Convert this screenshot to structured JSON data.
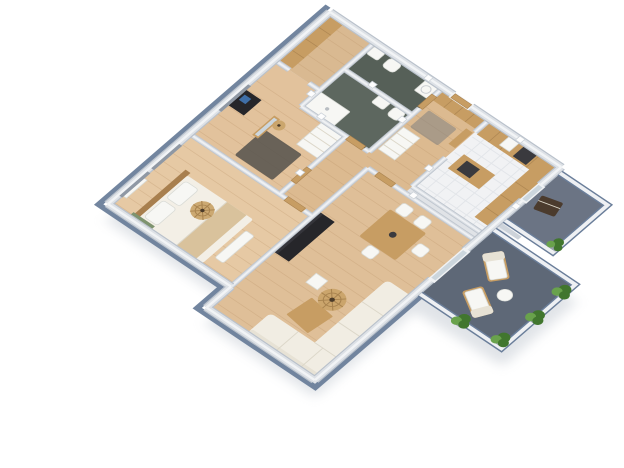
{
  "scene": {
    "type": "3d-floor-plan-render",
    "view": "rotated-isometric-top-down",
    "background": "white",
    "rooms": [
      {
        "name": "walk-in-closet",
        "floor": "wood",
        "furniture": [
          "built-in-wardrobe"
        ]
      },
      {
        "name": "bathroom-small",
        "floor": "dark-green-tile",
        "furniture": [
          "sink",
          "toilet",
          "washing-machine"
        ]
      },
      {
        "name": "bathroom-large",
        "floor": "dark-green-tile",
        "furniture": [
          "shower-tray",
          "sink",
          "toilet"
        ]
      },
      {
        "name": "entry-hall",
        "floor": "wood",
        "furniture": [
          "built-in-wardrobe",
          "cabinet",
          "dresser",
          "rug"
        ]
      },
      {
        "name": "corridor",
        "floor": "wood",
        "furniture": []
      },
      {
        "name": "kitchen",
        "floor": "white-tile",
        "furniture": [
          "counter-north",
          "counter-east",
          "island",
          "cooktop",
          "oven",
          "sink"
        ]
      },
      {
        "name": "bedroom-secondary",
        "floor": "wood",
        "furniture": [
          "desk",
          "standing-mirror",
          "rug",
          "pendant-lamp"
        ]
      },
      {
        "name": "bedroom-primary",
        "floor": "wood",
        "furniture": [
          "double-bed",
          "pillows",
          "blanket",
          "bench",
          "radiator",
          "tv-panel",
          "rattan-pendant-lamp"
        ]
      },
      {
        "name": "living-dining-room",
        "floor": "wood",
        "furniture": [
          "black-sideboard",
          "dining-table",
          "dining-chairs",
          "corner-sofa",
          "coffee-table",
          "side-table",
          "rattan-pendant-lamp"
        ]
      },
      {
        "name": "balcony-main",
        "floor": "slate",
        "furniture": [
          "lounge-chair",
          "lounge-chair",
          "side-table",
          "plants"
        ]
      },
      {
        "name": "balcony-kitchen",
        "floor": "slate",
        "furniture": [
          "grill",
          "plant"
        ]
      }
    ],
    "plant_count": 5,
    "lounge_chair_count": 2,
    "dining_chair_count": 4
  },
  "colors": {
    "bg": "#ffffff",
    "plinth": "#6a7e9a",
    "wood_floor_1": "#e6c9a4",
    "wood_floor_2": "#e2c29c",
    "wood_floor_3": "#dcba90",
    "wood_floor_4": "#dfbf98",
    "wood_floor_5": "#d9b991",
    "plank": "#bb9268",
    "tile_floor": "#f1f2f4",
    "tile_grid": "#e2e5e9",
    "bath_floor_1": "#5d675f",
    "bath_floor_2": "#566058",
    "balcony_floor_1": "#5e6877",
    "balcony_floor_2": "#6b7484",
    "parapet": "#eef0f3",
    "furn_wood": "#c79d63",
    "furn_wood_dark": "#a87f4e",
    "furn_white": "#f7f7f4",
    "furn_cream": "#f1ede3",
    "cushion": "#e7e2d5",
    "furn_black": "#26262a",
    "rug_dark": "#54514c",
    "rug_gray": "#787b80",
    "curtain": "#8f98a4",
    "glass": "#ccd6dd",
    "tv_green": "#7e936f",
    "duvet": "#f3efe6",
    "blanket": "#d9c29c",
    "plant_dark": "#41762e",
    "plant_light": "#69a24c",
    "planter": "#99a1ab",
    "appliance": "#3a3a3e",
    "grill": "#4b3b2d",
    "lamp": "#c9a368",
    "shadow": "#bcc3cc"
  }
}
